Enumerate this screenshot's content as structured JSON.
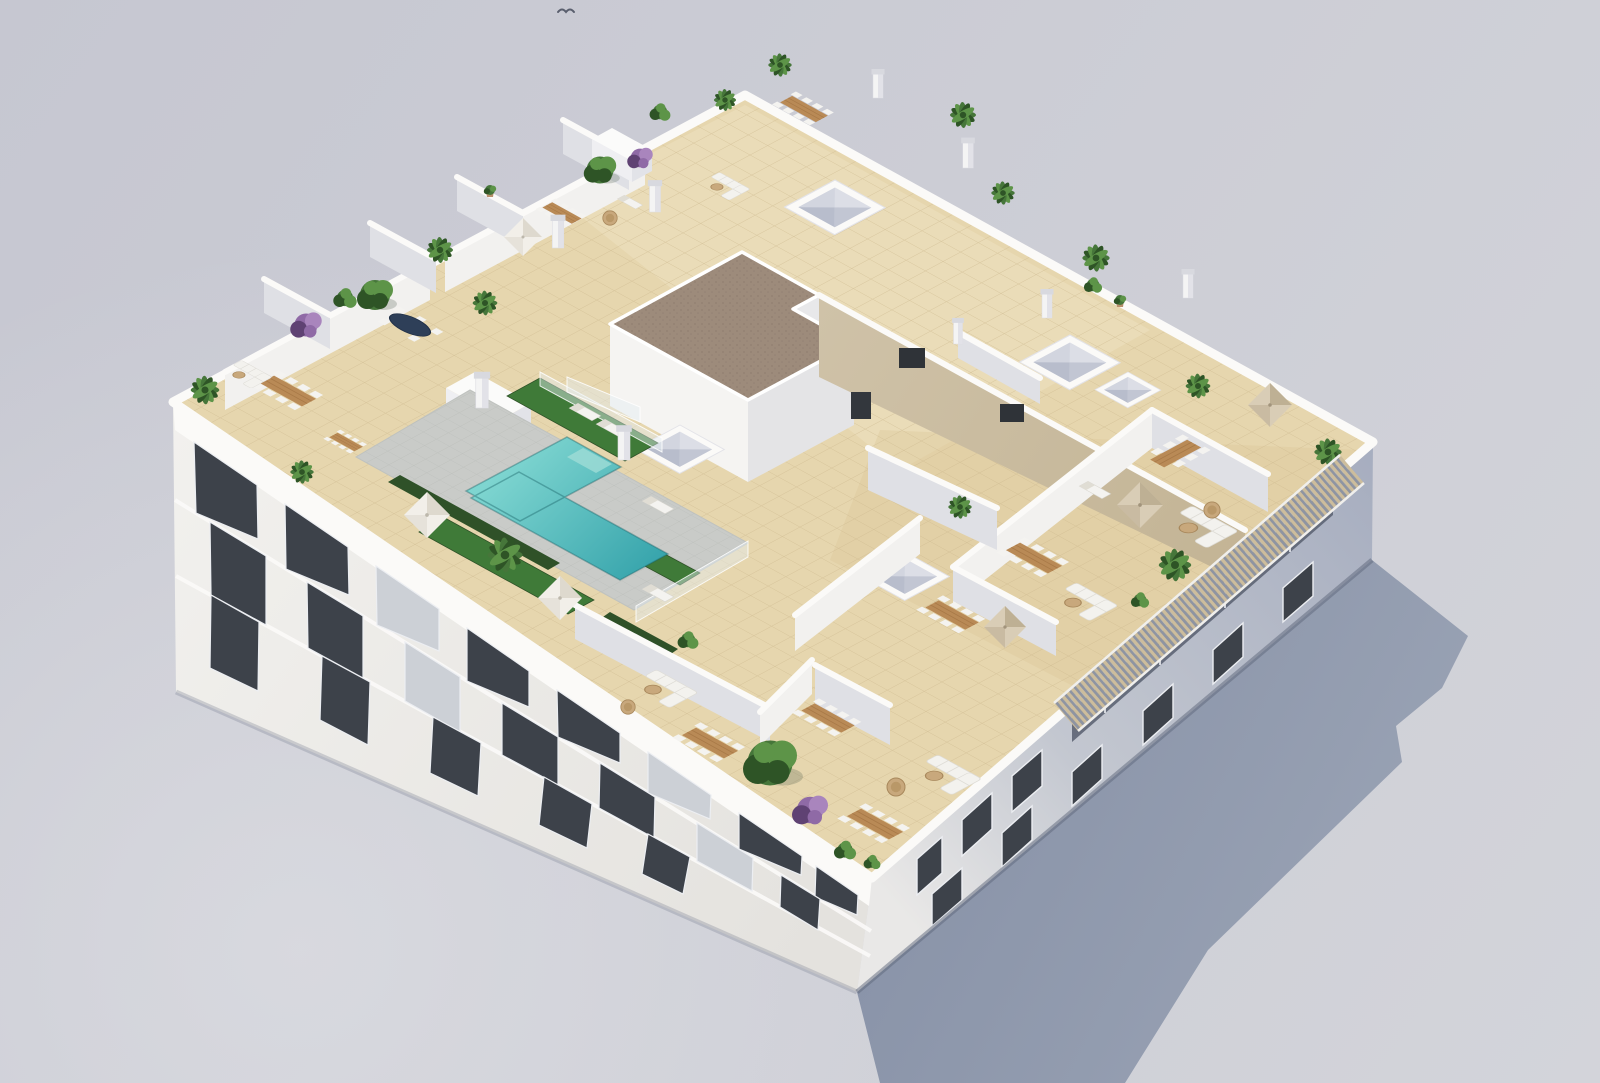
{
  "scene": {
    "type": "architectural-3d-render",
    "subject": "Aerial oblique view of a white Mediterranean apartment block with rooftop terraces, swimming pool, parasols and planting",
    "view": "aerial-oblique",
    "setting": "daylight, hard sun from upper-left, long blue shadow cast to lower-right",
    "building": {
      "style": "white modern Mediterranean block",
      "visible_facades": [
        "southwest sunlit facade with balconies",
        "southeast shaded facade with windows and slatted pergola"
      ],
      "roof": "communal rooftop with private tiled terraces separated by white walls"
    },
    "inventory": {
      "swimming_pools": 1,
      "parasols": 6,
      "dining_sets": 10,
      "sofa_sets": 6,
      "sun_loungers": 6,
      "round_tables": 4,
      "skylights": 4,
      "chimneys": 9,
      "grass_patches": 3,
      "plants": 29,
      "pergolas": 1,
      "stair_bulkheads": 1,
      "birds": 1
    }
  },
  "palette": {
    "bg_top": "#c6c7d1",
    "bg_bottom": "#d3d4da",
    "ground_light": "#dcdde2",
    "shadow_near": "#8a94a9",
    "shadow_far": "#9ca5b6",
    "facade_sun": "#f2f1ee",
    "facade_sun_dark": "#e4e2de",
    "facade_shade_near": "#e9e8e7",
    "facade_shade_far": "#a6adbf",
    "parapet": "#fbfaf8",
    "wall_bright": "#f2f1ef",
    "wall_shade": "#dfe0e5",
    "wall_tan": "#cfc2a8",
    "wall_tan_dark": "#c3b495",
    "window_dark": "#3d424a",
    "window_frame": "#eceef2",
    "balcony_recess": "#5b6272",
    "curtain": "#ccd0d6",
    "roof_tile": "#e6d6ae",
    "tile_line": "#cdb88e",
    "tile_warm": "#dcc79c",
    "tile_pale": "#f0e4c6",
    "gravel": "#9d8b7b",
    "gravel_dot": "#87766a",
    "pool_light": "#7ed5d0",
    "pool_deep": "#2f9fa8",
    "pool_deck": "#c9cbc8",
    "deck_line": "#b7bab6",
    "grass": "#3f7a38",
    "grass_dark": "#2f5128",
    "plant_mid": "#46763a",
    "plant_dark": "#2e5426",
    "plant_light": "#5d9448",
    "purple_light": "#a985bd",
    "purple_mid": "#8f6aa6",
    "purple_dark": "#5f4273",
    "wood": "#b98a56",
    "wood_dark": "#a87947",
    "chair_white": "#f4f3f0",
    "sofa_white": "#f3f2ee",
    "parasol_white": "#f2efe9",
    "parasol_white_shade": "#d8d3c7",
    "parasol_beige": "#d9cdb6",
    "parasol_beige_shade": "#b9aa8e",
    "navy": "#2e3f58",
    "rattan": "#c8a87c",
    "pot": "#b9906c",
    "pergola_wood": "#cdbd9c",
    "pergola_gap": "#8e94a2",
    "chimney_cap": "#d8d9df",
    "bird": "#5a5f6e"
  }
}
